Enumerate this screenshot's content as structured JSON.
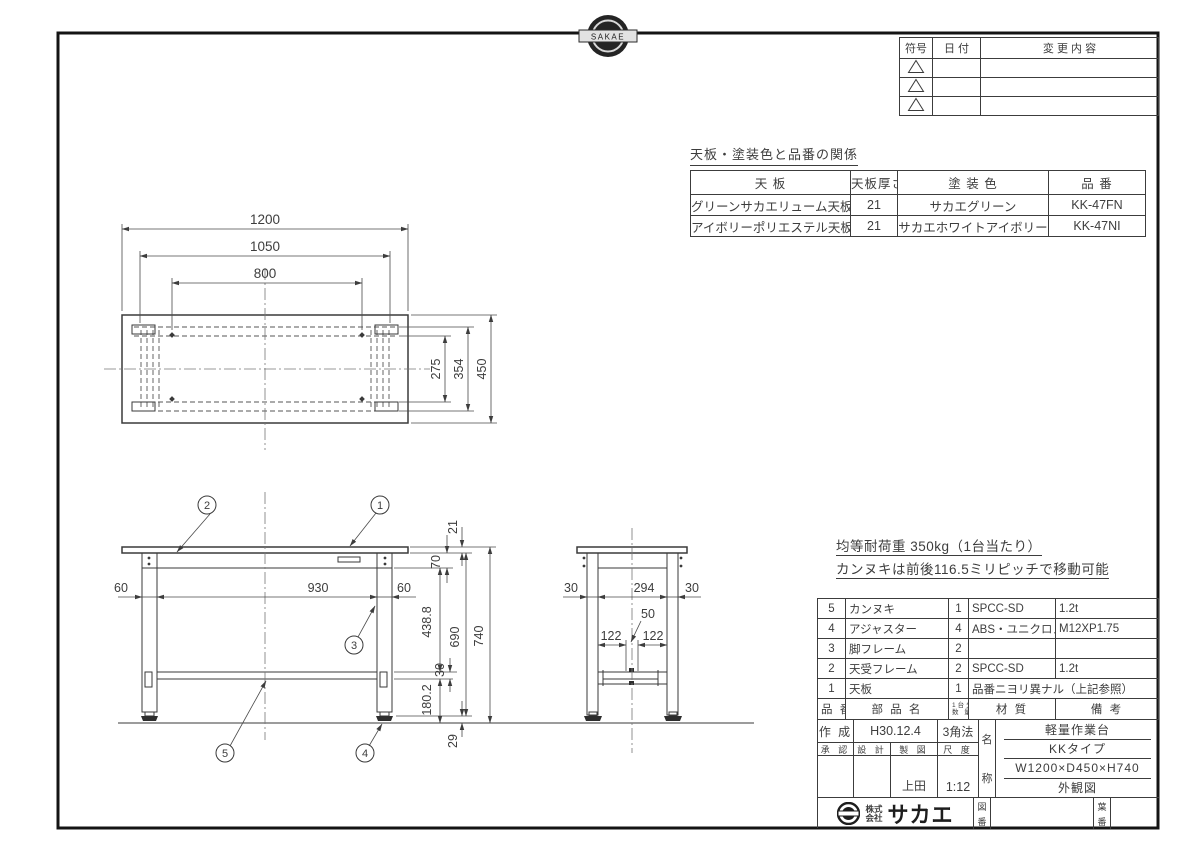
{
  "sheet": {
    "stamp_text": "SAKAE"
  },
  "revision_table": {
    "col_code": "符号",
    "col_date": "日 付",
    "col_change": "変 更 内 容"
  },
  "finish_table": {
    "title": "天板・塗装色と品番の関係",
    "h_top": "天 板",
    "h_thickness": "天板厚さ",
    "h_color": "塗 装 色",
    "h_part_no": "品 番",
    "rows": [
      {
        "top": "グリーンサカエリューム天板",
        "thickness": "21",
        "color": "サカエグリーン",
        "part_no": "KK-47FN"
      },
      {
        "top": "アイボリーポリエステル天板",
        "thickness": "21",
        "color": "サカエホワイトアイボリー",
        "part_no": "KK-47NI"
      }
    ]
  },
  "notes": {
    "load": "均等耐荷重 350kg（1台当たり）",
    "move": "カンヌキは前後116.5ミリピッチで移動可能"
  },
  "parts_table": {
    "h_no": "品 番",
    "h_name": "部 品 名",
    "h_qty_1": "1台分",
    "h_qty_2": "数 量",
    "h_material": "材 質",
    "h_remarks": "備 考",
    "rows": [
      {
        "no": "5",
        "name": "カンヌキ",
        "qty": "1",
        "material": "SPCC-SD",
        "remarks": "1.2t"
      },
      {
        "no": "4",
        "name": "アジャスター",
        "qty": "4",
        "material": "ABS・ユニクロメッキ",
        "remarks": "M12XP1.75"
      },
      {
        "no": "3",
        "name": "脚フレーム",
        "qty": "2",
        "material": "",
        "remarks": ""
      },
      {
        "no": "2",
        "name": "天受フレーム",
        "qty": "2",
        "material": "SPCC-SD",
        "remarks": "1.2t"
      },
      {
        "no": "1",
        "name": "天板",
        "qty": "1",
        "material": "品番ニヨリ異ナル（上記参照）",
        "remarks": ""
      }
    ]
  },
  "title_block": {
    "created_label": "作 成",
    "created_value": "H30.12.4",
    "projection": "3角法",
    "approved_label": "承 認",
    "designed_label": "設 計",
    "drafted_label": "製 図",
    "scale_label": "尺 度",
    "drafted_value": "上田",
    "scale_value": "1:12",
    "name_label_1": "名",
    "name_label_2": "称",
    "product_type": "軽量作業台",
    "product_series": "KKタイプ",
    "product_size": "W1200×D450×H740",
    "drawing_kind": "外観図",
    "company_prefix_1": "株式",
    "company_prefix_2": "会社",
    "company_name": "サカエ",
    "drawing_no_1": "図",
    "drawing_no_2": "番",
    "sheet_no_1": "葉",
    "sheet_no_2": "番"
  },
  "dims": {
    "top": {
      "w1200": "1200",
      "w1050": "1050",
      "w800": "800",
      "d450": "450",
      "d354": "354",
      "d275": "275"
    },
    "front": {
      "e60l": "60",
      "c930": "930",
      "e60r": "60",
      "t21": "21",
      "h70": "70",
      "h438": "438.8",
      "h690": "690",
      "h740": "740",
      "h30": "30",
      "h180": "180.2",
      "h29": "29"
    },
    "side": {
      "e30l": "30",
      "c294": "294",
      "e30r": "30",
      "s50": "50",
      "l122": "122",
      "r122": "122"
    }
  },
  "callouts": {
    "c1": "1",
    "c2": "2",
    "c3": "3",
    "c4": "4",
    "c5": "5"
  }
}
